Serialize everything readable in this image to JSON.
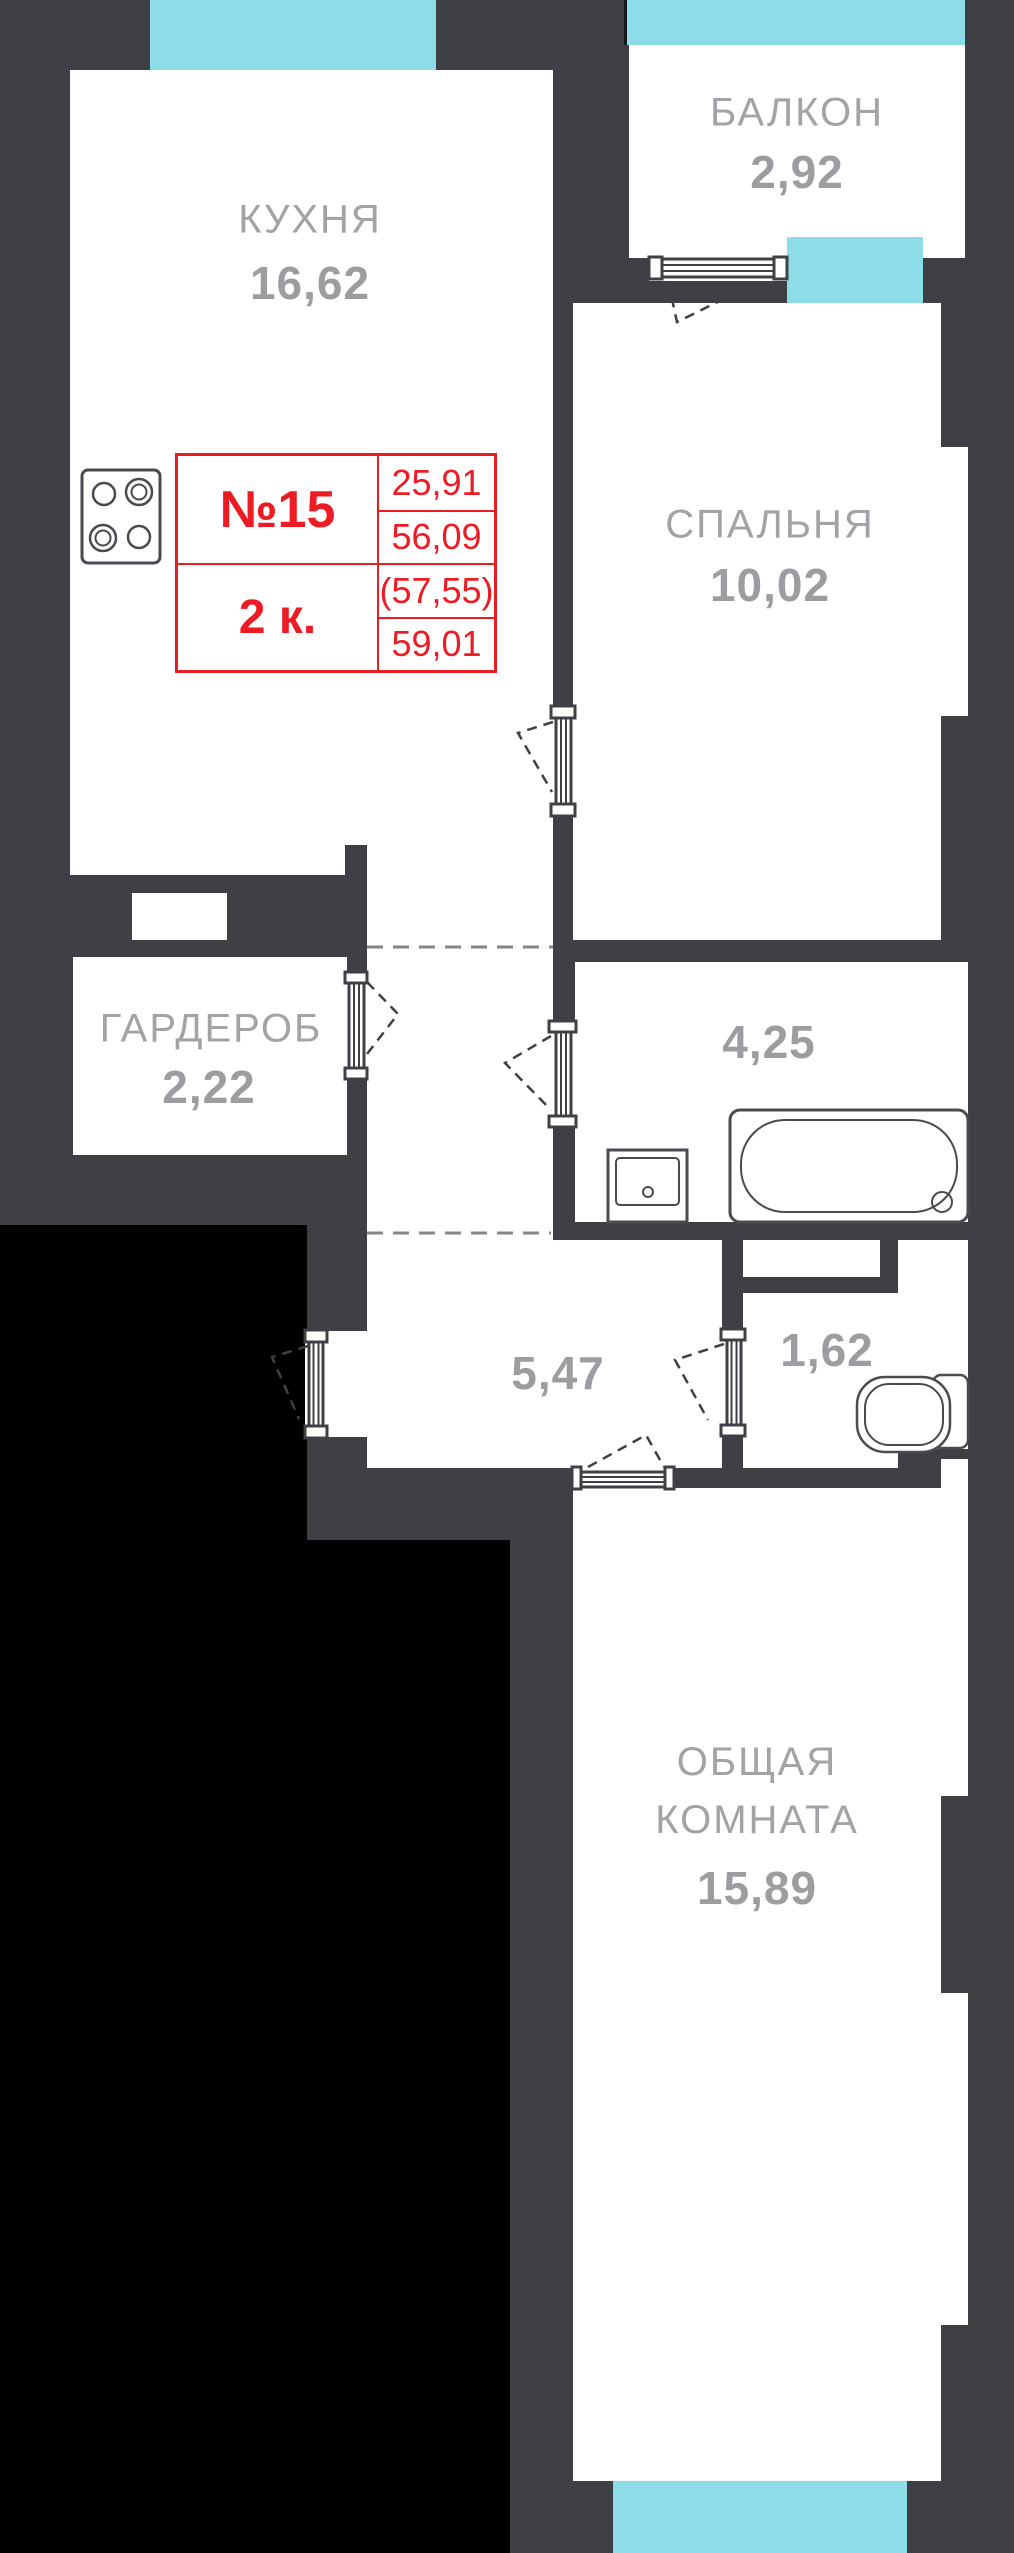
{
  "title": "План квартиры №15 (2-комнатная)",
  "colors": {
    "wall": "#3f4045",
    "room_fill": "#ffffff",
    "window": "#8ddde9",
    "outside": "#000000",
    "label_gray": "#a3a3a7",
    "accent_red": "#ed1c24"
  },
  "info_box": {
    "apartment_number": "№15",
    "apartment_type": "2 к.",
    "area_living": "25,91",
    "area_flat": "56,09",
    "area_with_balcony_coef": "(57,55)",
    "area_total": "59,01"
  },
  "rooms": {
    "balcony": {
      "name": "БАЛКОН",
      "area": "2,92"
    },
    "kitchen": {
      "name": "КУХНЯ",
      "area": "16,62"
    },
    "bedroom": {
      "name": "СПАЛЬНЯ",
      "area": "10,02"
    },
    "wardrobe": {
      "name": "ГАРДЕРОБ",
      "area": "2,22"
    },
    "bathroom": {
      "area": "4,25"
    },
    "hallway": {
      "area": "5,47"
    },
    "wc": {
      "area": "1,62"
    },
    "living": {
      "name_line1": "ОБЩАЯ",
      "name_line2": "КОМНАТА",
      "area": "15,89"
    }
  },
  "fixtures": {
    "stove": "плита",
    "sink": "раковина",
    "bathtub": "ванна",
    "toilet": "унитаз"
  }
}
